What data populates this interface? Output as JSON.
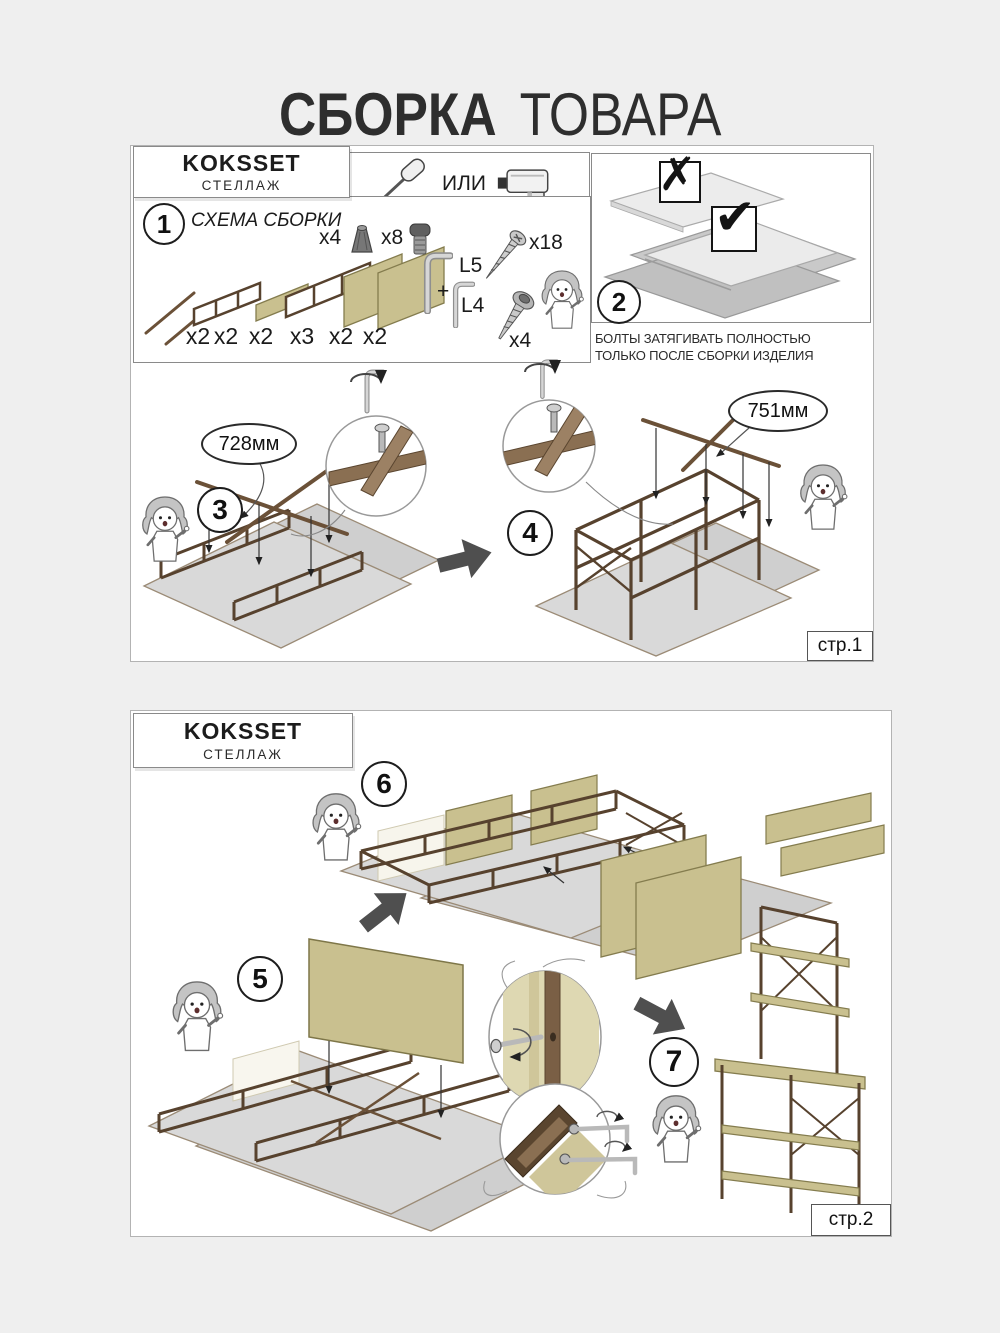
{
  "title": {
    "word_bold": "СБОРКА",
    "word_light": "ТОВАРА"
  },
  "page1": {
    "header": {
      "product": "KOKSSET",
      "type": "СТЕЛЛАЖ"
    },
    "tools": {
      "or": "ИЛИ"
    },
    "step1": {
      "num": "1",
      "title": "СХЕМА СБОРКИ",
      "quantities": [
        "x2",
        "x2",
        "x2",
        "x3",
        "x2",
        "x2"
      ],
      "hw_foot": "x4",
      "hw_bolt": "x8",
      "hw_screw": "x18",
      "hw_key_big": "L5",
      "hw_plus": "+",
      "hw_key_small": "L4",
      "hw_socket": "x4"
    },
    "step2": {
      "num": "2",
      "wrong": "✗",
      "right": "✔",
      "warn1": "БОЛТЫ ЗАТЯГИВАТЬ ПОЛНОСТЬЮ",
      "warn2": "ТОЛЬКО ПОСЛЕ СБОРКИ ИЗДЕЛИЯ"
    },
    "step3": {
      "num": "3",
      "dim": "728мм"
    },
    "step4": {
      "num": "4",
      "dim": "751мм"
    },
    "page_label": "стр.1"
  },
  "page2": {
    "header": {
      "product": "KOKSSET",
      "type": "СТЕЛЛАЖ"
    },
    "step5": {
      "num": "5"
    },
    "step6": {
      "num": "6"
    },
    "step7": {
      "num": "7"
    },
    "page_label": "стр.2"
  },
  "colors": {
    "background": "#efefef",
    "panel_khaki": "#c9c08f",
    "frame_brown": "#57422e",
    "cardboard": "#d8d8d8",
    "arrow_dark": "#4f4f4f"
  }
}
